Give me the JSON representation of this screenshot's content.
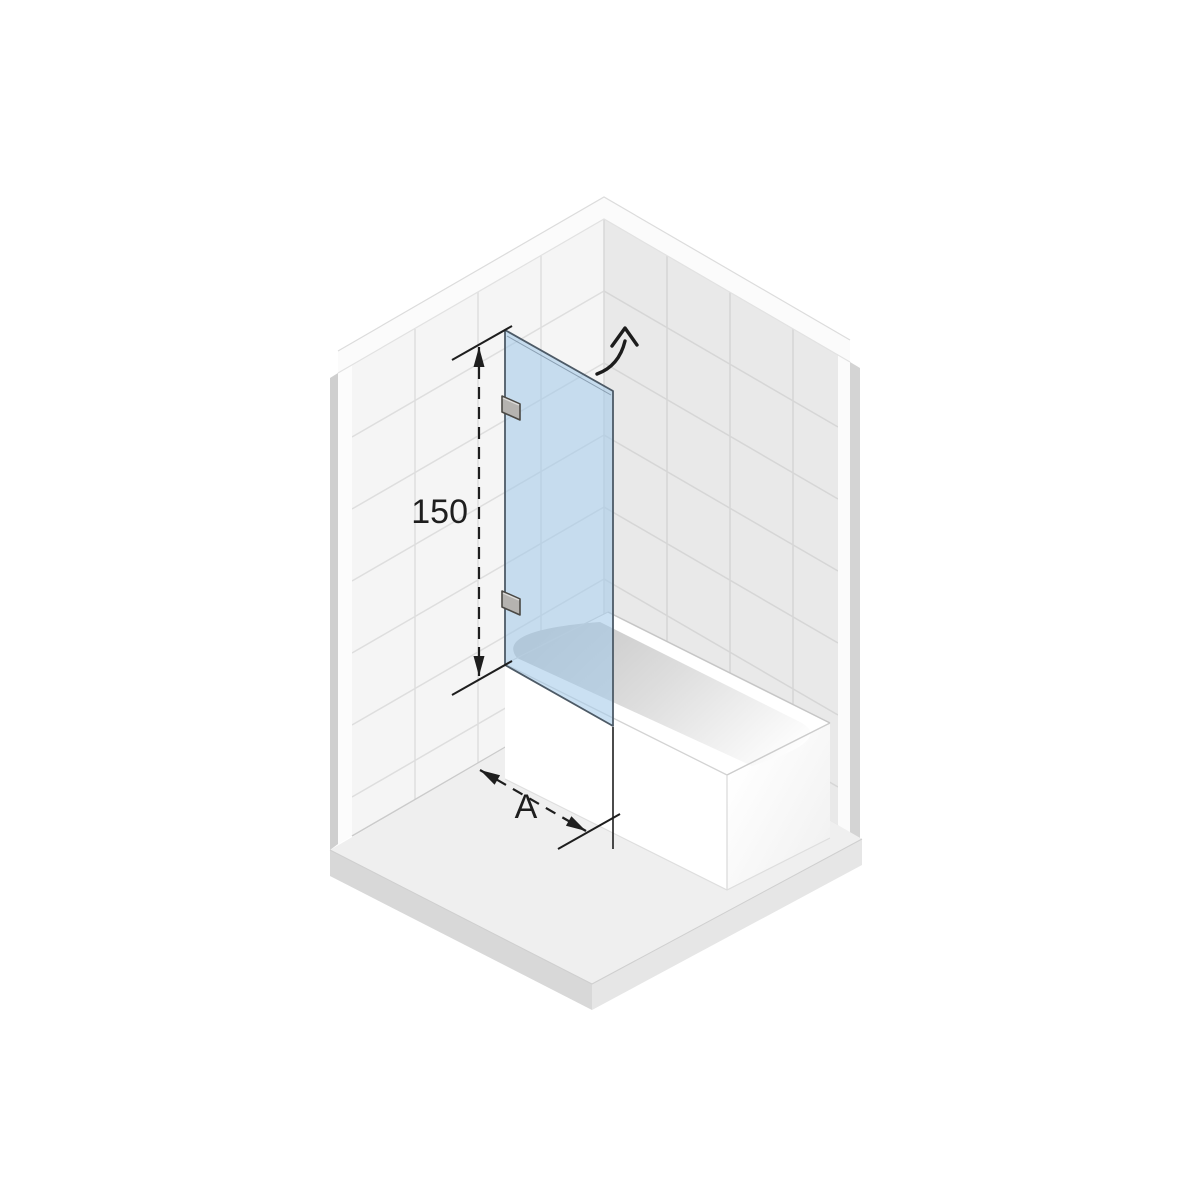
{
  "diagram": {
    "type": "isometric-product-diagram",
    "subject": "bath screen glass panel mounted on tiled wall over bathtub",
    "labels": {
      "height": "150",
      "width": "A"
    },
    "annotations": {
      "swing_arrow": "curved-arrow-outward-swing",
      "height_dimension": "vertical dashed double-arrow line with end ticks",
      "width_dimension": "isometric dashed double-arrow line with end tick and extension line"
    },
    "colors": {
      "background": "#ffffff",
      "glass_fill": "rgba(164,201,233,0.58)",
      "glass_edge": "#4d5a66",
      "wall_left_tile": "#f5f5f5",
      "wall_right_tile": "#e9e9e9",
      "grout_left": "#dedede",
      "grout_right": "#d6d6d6",
      "wall_cap": "#fbfbfb",
      "wall_side_left": "#cfcfcf",
      "wall_side_right": "#d4d4d4",
      "floor_top": "#efefef",
      "floor_face_left": "#d8d8d8",
      "floor_face_right": "#e6e6e6",
      "tub_white": "#ffffff",
      "basin_shadow": "#c8c8c8",
      "bracket_fill": "#b5b3b0",
      "bracket_edge": "#4a4844",
      "dimension_ink": "#1e1e1e"
    }
  }
}
